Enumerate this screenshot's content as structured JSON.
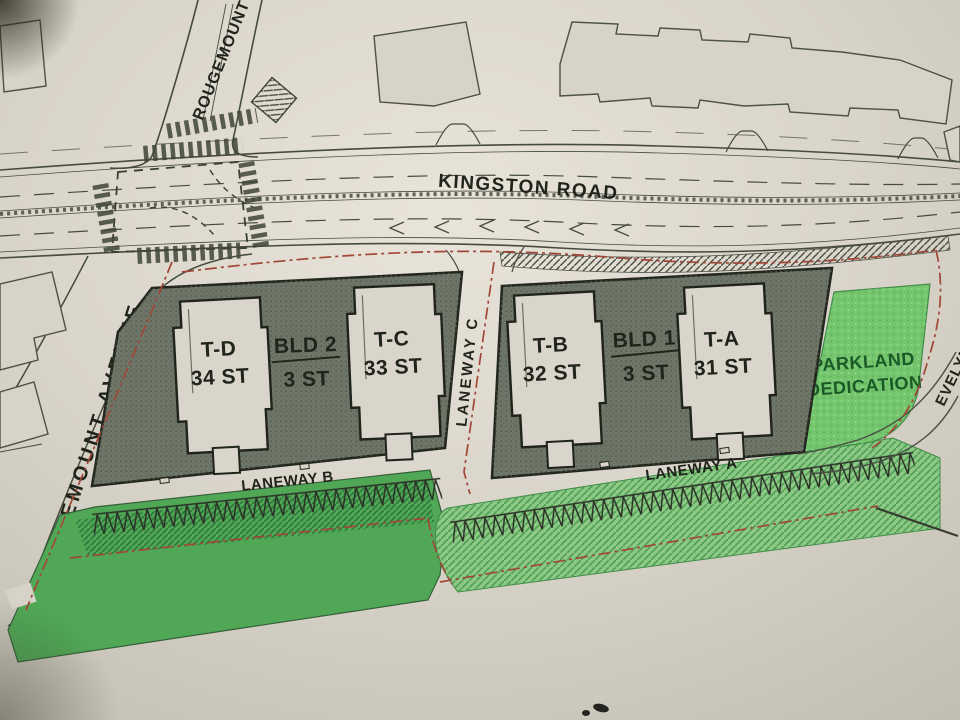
{
  "title": "Kingston Road site plan",
  "labels": {
    "rougemount_top": "ROUGEMOUNT",
    "kingston_road": "KINGSTON ROAD",
    "rougemount_avenue": "ROUGEMOUNT AVENUE",
    "laneway_a": "LANEWAY A",
    "laneway_b": "LANEWAY B",
    "laneway_c": "LANEWAY C",
    "evelyn": "EVELYN",
    "parkland_line1": "PARKLAND",
    "parkland_line2": "DEDICATION"
  },
  "buildings": {
    "bld1": {
      "name": "BLD 1",
      "storeys": "3 ST"
    },
    "bld2": {
      "name": "BLD 2",
      "storeys": "3 ST"
    },
    "towers": [
      {
        "id": "T-D",
        "storeys": "34 ST"
      },
      {
        "id": "T-C",
        "storeys": "33 ST"
      },
      {
        "id": "T-B",
        "storeys": "32 ST"
      },
      {
        "id": "T-A",
        "storeys": "31 ST"
      }
    ]
  },
  "colors": {
    "paper": "#d8d3c8",
    "paper_light": "#e8e3d9",
    "paper_dark": "#c2bfb4",
    "ink": "#464b3f",
    "outline_dark": "#22261e",
    "podium": "#6f7668",
    "podium_dot": "#545d4d",
    "tower": "#dad5cb",
    "existing_bldg": "#d7d3c8",
    "parkland": "#74c56e",
    "parkland_text": "#1b5a26",
    "green_solid": "#50a755",
    "green_hatch_base": "#8cc985",
    "green_hatch_line": "#4f9e54",
    "green_dark_hatch": "#2f7a3c",
    "boundary_red": "#a04738",
    "label_ink": "#20241b"
  }
}
